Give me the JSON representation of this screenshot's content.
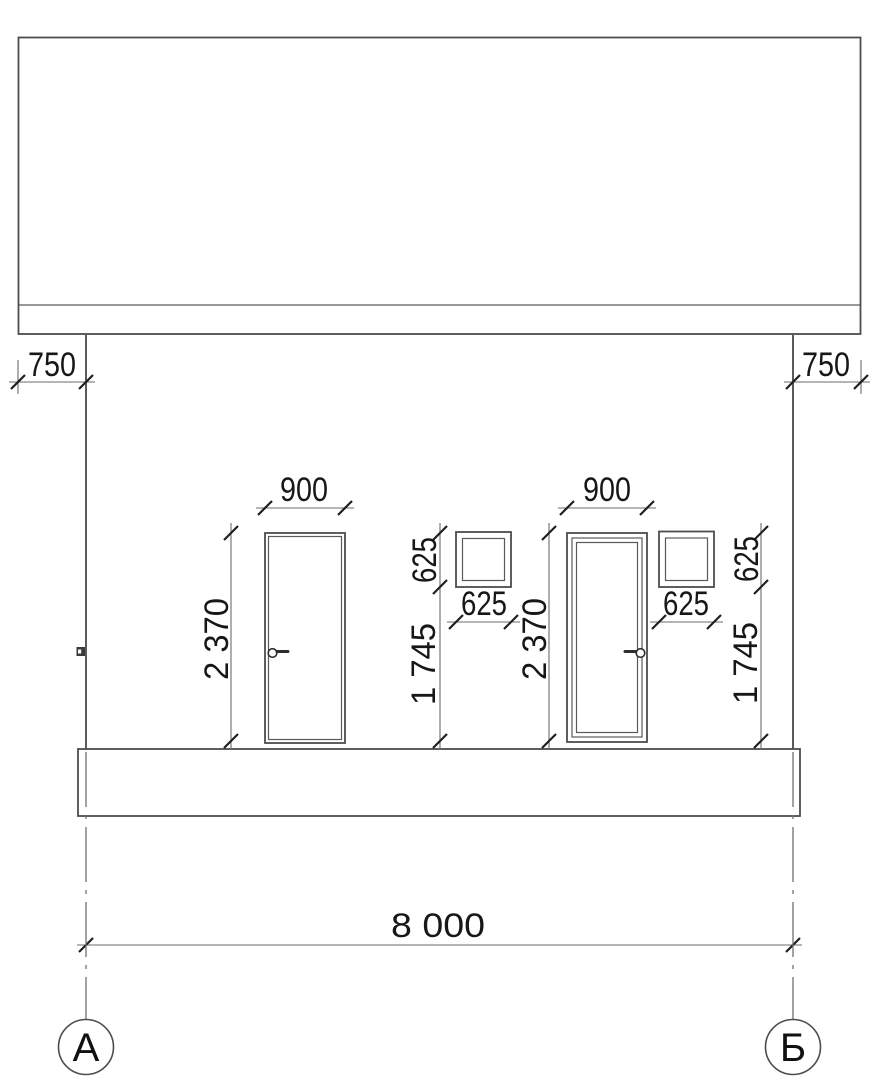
{
  "drawing": {
    "kind": "building-facade-elevation",
    "colors": {
      "background": "#ffffff",
      "main_line": "#4d4d4d",
      "dimension_line": "#6b6b6b",
      "text": "#171717"
    }
  },
  "dim": {
    "overhang_left": "750",
    "overhang_right": "750",
    "door_left_width": "900",
    "door_right_width": "900",
    "door_left_height": "2 370",
    "door_right_height": "2 370",
    "window_left_height": "625",
    "window_left_width": "625",
    "window_left_sill": "1 745",
    "window_right_height": "625",
    "window_right_width": "625",
    "window_right_sill": "1 745",
    "overall_width": "8 000"
  },
  "axis": {
    "left": "А",
    "right": "Б"
  }
}
